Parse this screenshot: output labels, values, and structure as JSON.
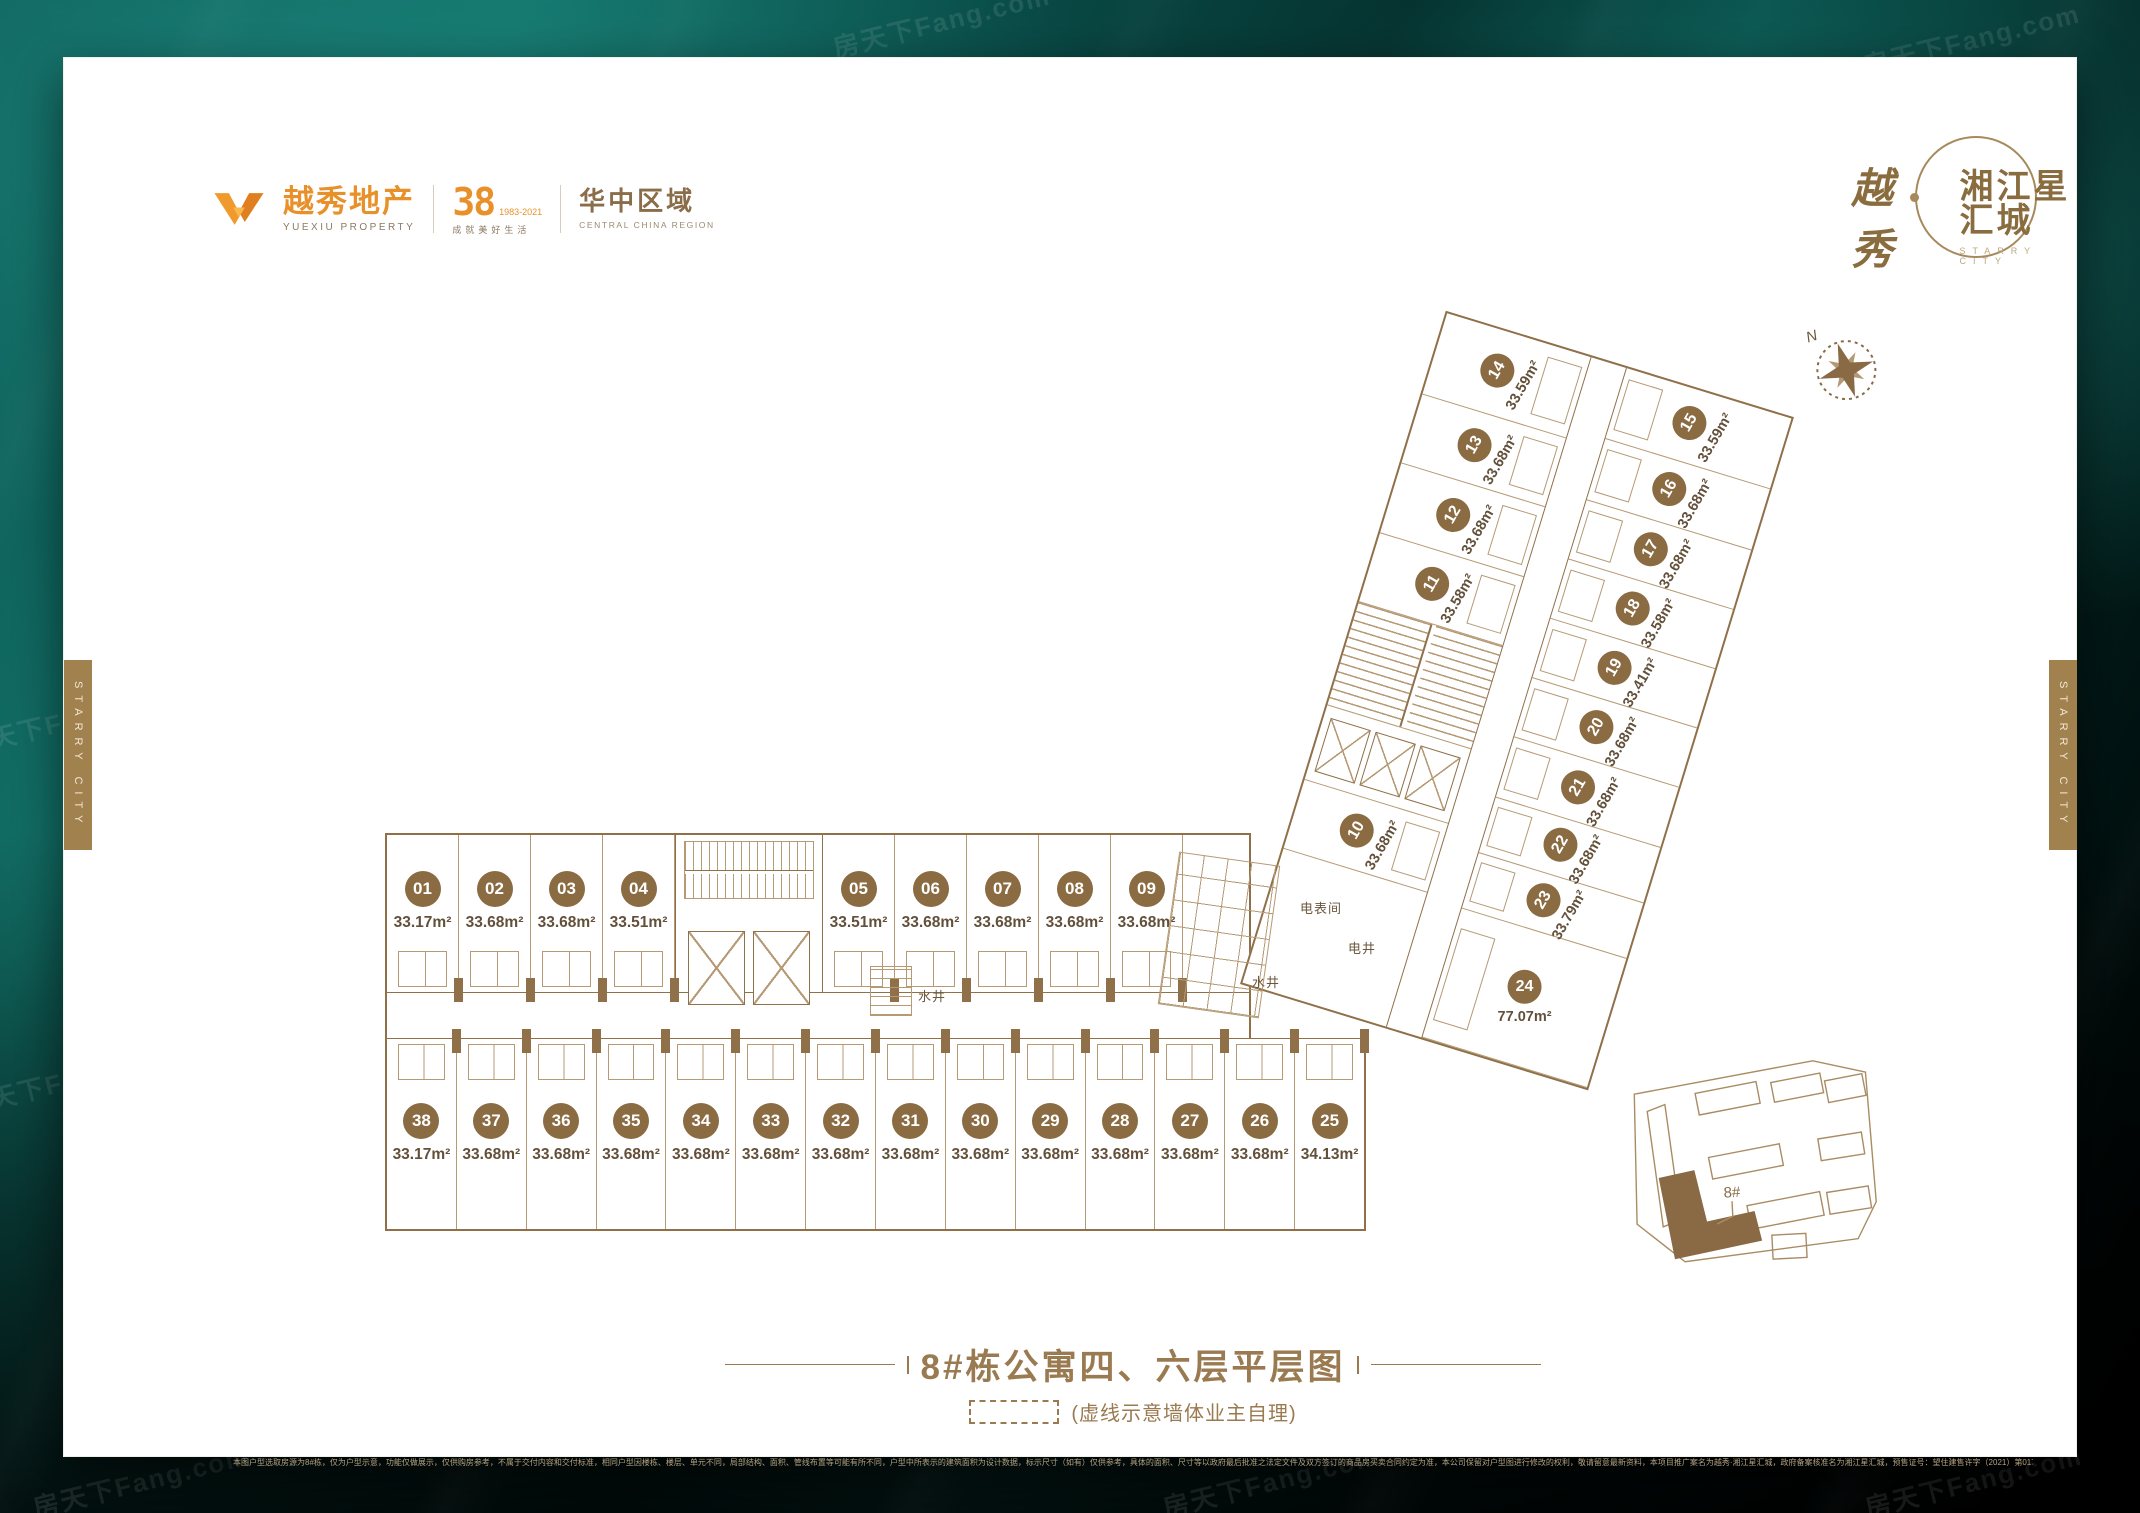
{
  "brand": {
    "yuexiu_cn": "越秀地产",
    "yuexiu_en": "YUEXIU PROPERTY",
    "anniversary": "38",
    "anniversary_years": "1983-2021",
    "anniversary_slogan": "成就美好生活",
    "region_cn": "华中区域",
    "region_en": "CENTRAL CHINA REGION",
    "calligraphy": "越秀",
    "project_name": "湘江星汇城",
    "project_en": "STARRY CITY"
  },
  "side_tab_text": "STARRY CITY",
  "compass_n": "N",
  "watermark_text": "房天下Fang.com",
  "plan": {
    "top_row": [
      {
        "no": "01",
        "area": "33.17m²"
      },
      {
        "no": "02",
        "area": "33.68m²"
      },
      {
        "no": "03",
        "area": "33.68m²"
      },
      {
        "no": "04",
        "area": "33.51m²"
      },
      {
        "no": "05",
        "area": "33.51m²"
      },
      {
        "no": "06",
        "area": "33.68m²"
      },
      {
        "no": "07",
        "area": "33.68m²"
      },
      {
        "no": "08",
        "area": "33.68m²"
      },
      {
        "no": "09",
        "area": "33.68m²"
      }
    ],
    "bottom_row": [
      {
        "no": "38",
        "area": "33.17m²"
      },
      {
        "no": "37",
        "area": "33.68m²"
      },
      {
        "no": "36",
        "area": "33.68m²"
      },
      {
        "no": "35",
        "area": "33.68m²"
      },
      {
        "no": "34",
        "area": "33.68m²"
      },
      {
        "no": "33",
        "area": "33.68m²"
      },
      {
        "no": "32",
        "area": "33.68m²"
      },
      {
        "no": "31",
        "area": "33.68m²"
      },
      {
        "no": "30",
        "area": "33.68m²"
      },
      {
        "no": "29",
        "area": "33.68m²"
      },
      {
        "no": "28",
        "area": "33.68m²"
      },
      {
        "no": "27",
        "area": "33.68m²"
      },
      {
        "no": "26",
        "area": "33.68m²"
      },
      {
        "no": "25",
        "area": "34.13m²"
      }
    ],
    "diag_left": [
      {
        "no": "14",
        "area": "33.59m²"
      },
      {
        "no": "13",
        "area": "33.68m²"
      },
      {
        "no": "12",
        "area": "33.68m²"
      },
      {
        "no": "11",
        "area": "33.58m²"
      },
      {
        "type": "stair"
      },
      {
        "type": "elev"
      },
      {
        "no": "10",
        "area": "33.68m²"
      },
      {
        "type": "blank"
      }
    ],
    "diag_right": [
      {
        "no": "15",
        "area": "33.59m²"
      },
      {
        "no": "16",
        "area": "33.68m²"
      },
      {
        "no": "17",
        "area": "33.68m²"
      },
      {
        "no": "18",
        "area": "33.58m²"
      },
      {
        "no": "19",
        "area": "33.41m²"
      },
      {
        "no": "20",
        "area": "33.68m²"
      },
      {
        "no": "21",
        "area": "33.68m²"
      },
      {
        "no": "22",
        "area": "33.68m²"
      },
      {
        "no": "23",
        "area": "33.79m²"
      },
      {
        "no": "24",
        "area": "77.07m²",
        "big": true
      }
    ],
    "rooms": {
      "meter": "电表间",
      "elec_shaft": "电井",
      "water_shaft": "水井"
    }
  },
  "keyplan": {
    "building_label": "8#"
  },
  "footer": {
    "title": "8#栋公寓四、六层平层图",
    "note": "(虚线示意墙体业主自理)",
    "disclaimer": "本图户型选取房源为8#栋，仅为户型示意，功能仅做展示，仅供购房参考，不属于交付内容和交付标准，相同户型因楼栋、楼层、单元不同，局部结构、面积、管线布置等可能有所不同，户型中所表示的建筑面积为设计数据，标示尺寸（如有）仅供参考，具体的面积、尺寸等以政府最后批准之法定文件及双方签订的商品房买卖合同约定为准，本公司保留对户型图进行修改的权利，敬请留意最新资料，本项目推广案名为越秀·湘江星汇城，政府备案核准名为湘江星汇城，预售证号：望住建售许字（2021）第0172号 第0173号 第0174号 第0183号 第0256号，本资料制作时间为2021年12月。"
  },
  "colors": {
    "accent_brown": "#8a6a45",
    "badge_brown": "#8a6b42",
    "logo_orange": "#e8912b",
    "tab_gold": "#a1814e",
    "background_teal": "#0c4f4b"
  }
}
